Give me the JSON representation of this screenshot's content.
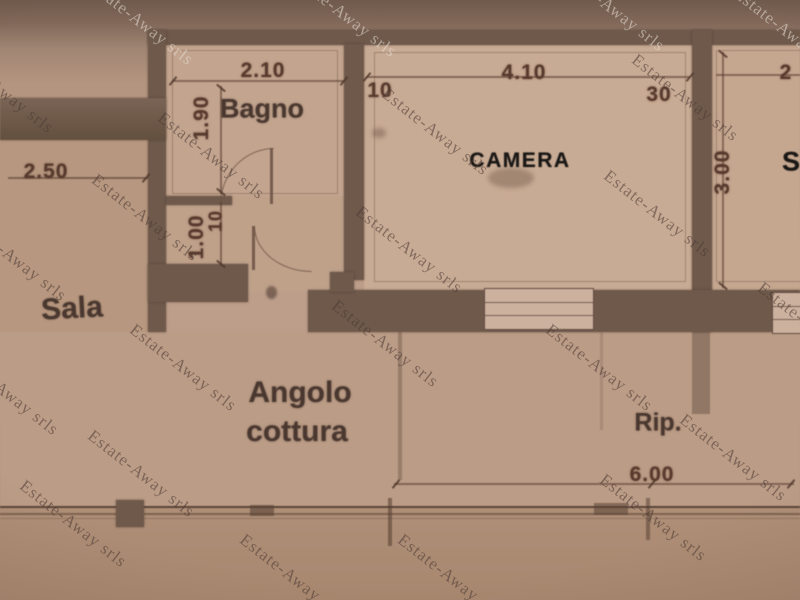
{
  "watermark": {
    "text": "Estate-Away srls"
  },
  "rooms": {
    "bagno": "Bagno",
    "camera": "CAMERA",
    "sala": "Sala",
    "angolo_line1": "Angolo",
    "angolo_line2": "cottura",
    "rip": "Rip.",
    "right_partial": "S"
  },
  "dims": {
    "bagno_width": "2.10",
    "bagno_height": "1.90",
    "camera_wall_left": "10",
    "camera_width": "4.10",
    "camera_wall_right": "30",
    "right_room_partial": "2",
    "right_room_height": "3.00",
    "sala_width": "2.50",
    "corridor_height": "1.00",
    "corridor_wall": "10",
    "total_width": "6.00"
  },
  "colors": {
    "paper": "#bd9e8a",
    "wall": "#6e594b",
    "ink": "#573a2d",
    "room_label": "#4a3830",
    "bold_label": "#191715"
  }
}
